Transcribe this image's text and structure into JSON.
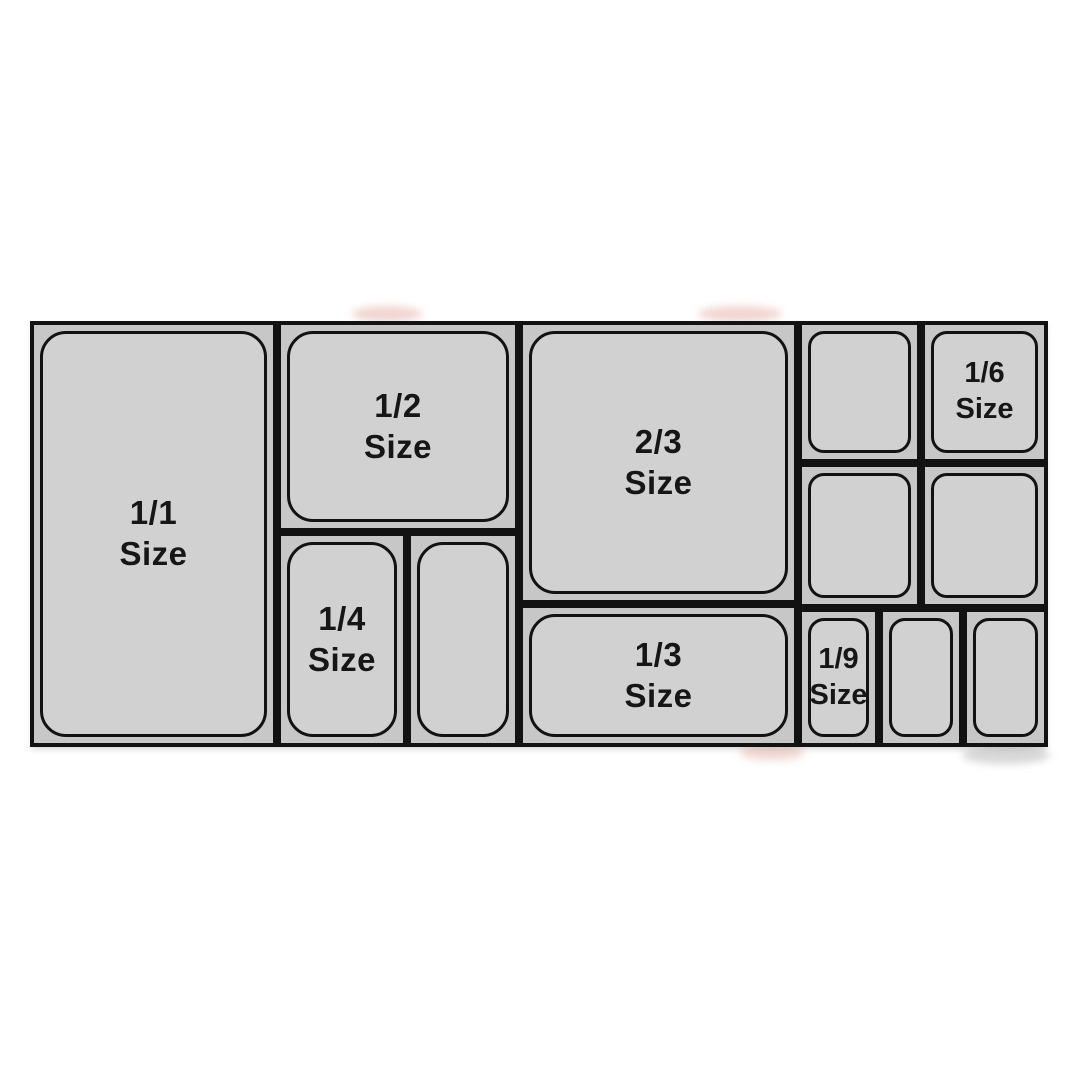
{
  "colors": {
    "background": "#ffffff",
    "line": "#121212",
    "cell_fill": "#c7c7c7",
    "pan_fill": "#d1d1d1",
    "text": "#161616"
  },
  "diagram": {
    "name": "gastronorm-pan-size-chart",
    "frame": {
      "x": 30,
      "y": 321,
      "w": 1018,
      "h": 426
    },
    "cells": [
      {
        "name": "pan-1-1",
        "label": [
          "1/1",
          "Size"
        ],
        "x": 0,
        "y": 0,
        "w": 247,
        "h": 426,
        "small": false
      },
      {
        "name": "pan-1-2",
        "label": [
          "1/2",
          "Size"
        ],
        "x": 247,
        "y": 0,
        "w": 242,
        "h": 211,
        "small": false
      },
      {
        "name": "pan-1-4",
        "label": [
          "1/4",
          "Size"
        ],
        "x": 247,
        "y": 211,
        "w": 130,
        "h": 215,
        "small": false
      },
      {
        "name": "pan-1-4-unlabeled",
        "label": [],
        "x": 377,
        "y": 211,
        "w": 112,
        "h": 215,
        "small": false
      },
      {
        "name": "pan-2-3",
        "label": [
          "2/3",
          "Size"
        ],
        "x": 489,
        "y": 0,
        "w": 279,
        "h": 283,
        "small": false
      },
      {
        "name": "pan-1-3",
        "label": [
          "1/3",
          "Size"
        ],
        "x": 489,
        "y": 283,
        "w": 279,
        "h": 143,
        "small": false
      },
      {
        "name": "pan-1-6-unlabeled-1",
        "label": [],
        "x": 768,
        "y": 0,
        "w": 123,
        "h": 142,
        "small": true
      },
      {
        "name": "pan-1-6",
        "label": [
          "1/6",
          "Size"
        ],
        "x": 891,
        "y": 0,
        "w": 127,
        "h": 142,
        "small": true
      },
      {
        "name": "pan-1-6-unlabeled-2",
        "label": [],
        "x": 768,
        "y": 142,
        "w": 123,
        "h": 145,
        "small": true
      },
      {
        "name": "pan-1-6-unlabeled-3",
        "label": [],
        "x": 891,
        "y": 142,
        "w": 127,
        "h": 145,
        "small": true
      },
      {
        "name": "pan-1-9",
        "label": [
          "1/9",
          "Size"
        ],
        "x": 768,
        "y": 287,
        "w": 81,
        "h": 139,
        "small": true
      },
      {
        "name": "pan-1-9-unlabeled-1",
        "label": [],
        "x": 849,
        "y": 287,
        "w": 84,
        "h": 139,
        "small": true
      },
      {
        "name": "pan-1-9-unlabeled-2",
        "label": [],
        "x": 933,
        "y": 287,
        "w": 85,
        "h": 139,
        "small": true
      }
    ]
  }
}
